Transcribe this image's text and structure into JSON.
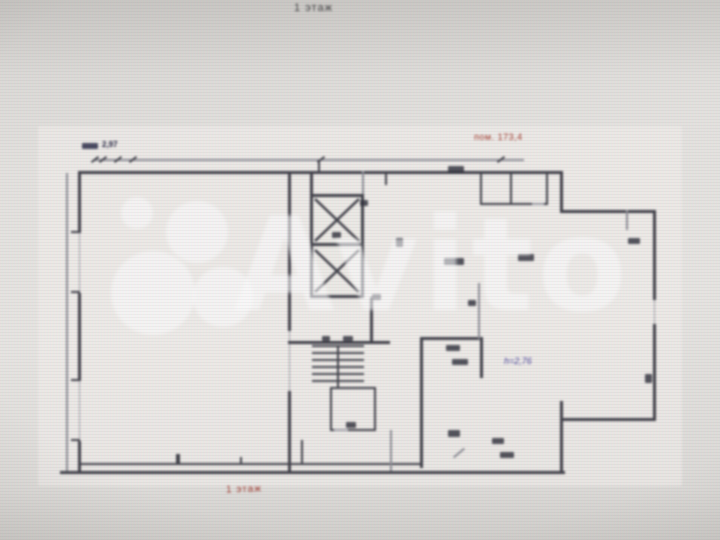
{
  "photo": {
    "floor_title_top": "1 этаж",
    "watermark": {
      "text": "Avito"
    },
    "plan": {
      "dimension_label": "2,97",
      "room_label_red": "пом. 173,4",
      "height_label": "h=2,76",
      "floor_label_bottom": "1 этаж"
    },
    "colors": {
      "background": "#e7e5e1",
      "wall": "#3f3f47",
      "red_label": "#a23a2c",
      "navy_label": "#23233f",
      "height_label": "#4a4499",
      "watermark": "#ffffff"
    }
  }
}
